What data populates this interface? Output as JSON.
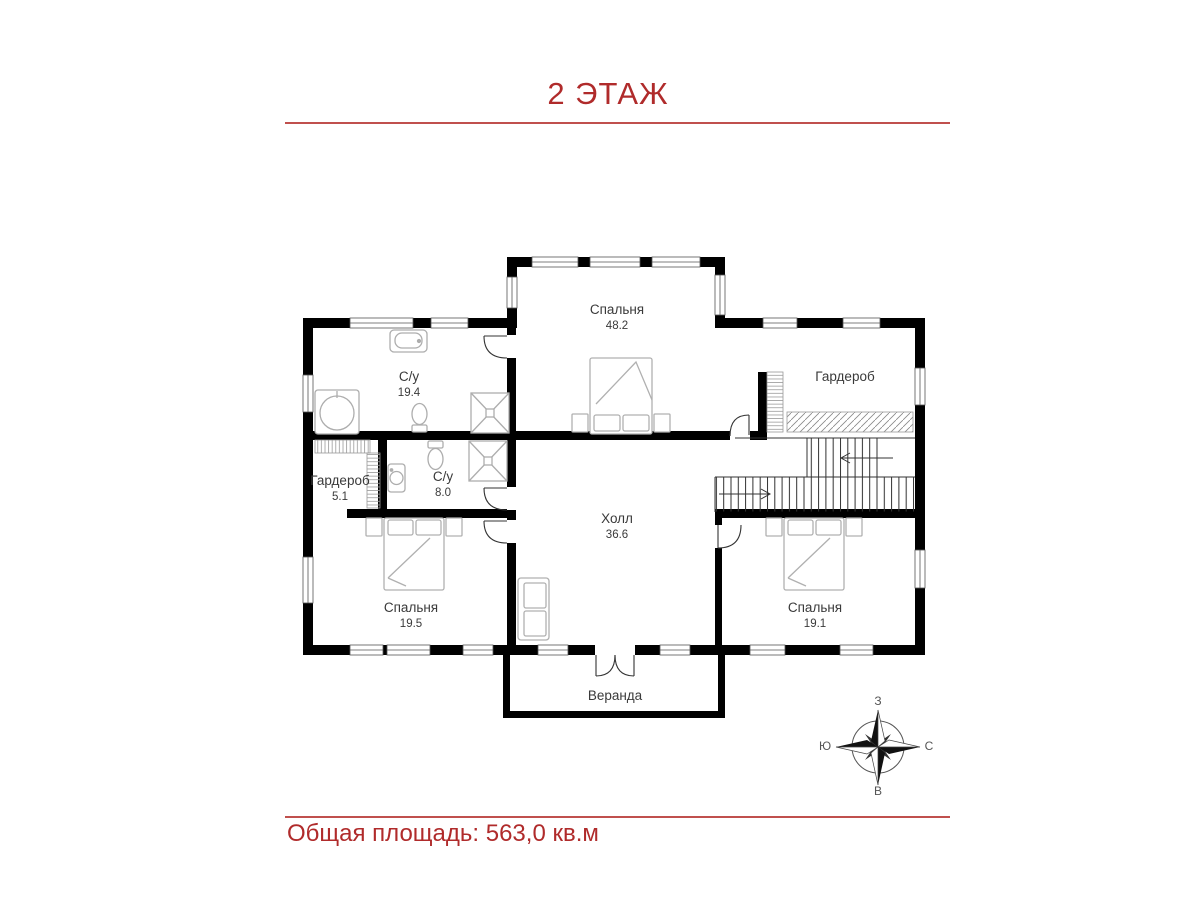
{
  "header": {
    "title": "2 ЭТАЖ"
  },
  "footer": {
    "total_area": "Общая площадь: 563,0 кв.м"
  },
  "colors": {
    "accent": "#b02b2b",
    "rule": "#c0504d",
    "wall": "#000000",
    "furniture": "#b0b0b0"
  },
  "plan": {
    "rooms": {
      "bedroom_top": {
        "name": "Спальня",
        "area": "48.2"
      },
      "bathroom_large": {
        "name": "С/у",
        "area": "19.4"
      },
      "wardrobe_small": {
        "name": "Гардероб",
        "area": "5.1"
      },
      "bathroom_small": {
        "name": "С/у",
        "area": "8.0"
      },
      "hall": {
        "name": "Холл",
        "area": "36.6"
      },
      "bedroom_left": {
        "name": "Спальня",
        "area": "19.5"
      },
      "bedroom_right": {
        "name": "Спальня",
        "area": "19.1"
      },
      "wardrobe_large": {
        "name": "Гардероб"
      },
      "veranda": {
        "name": "Веранда"
      }
    },
    "compass": {
      "top": "З",
      "right": "С",
      "bottom": "В",
      "left": "Ю"
    }
  }
}
